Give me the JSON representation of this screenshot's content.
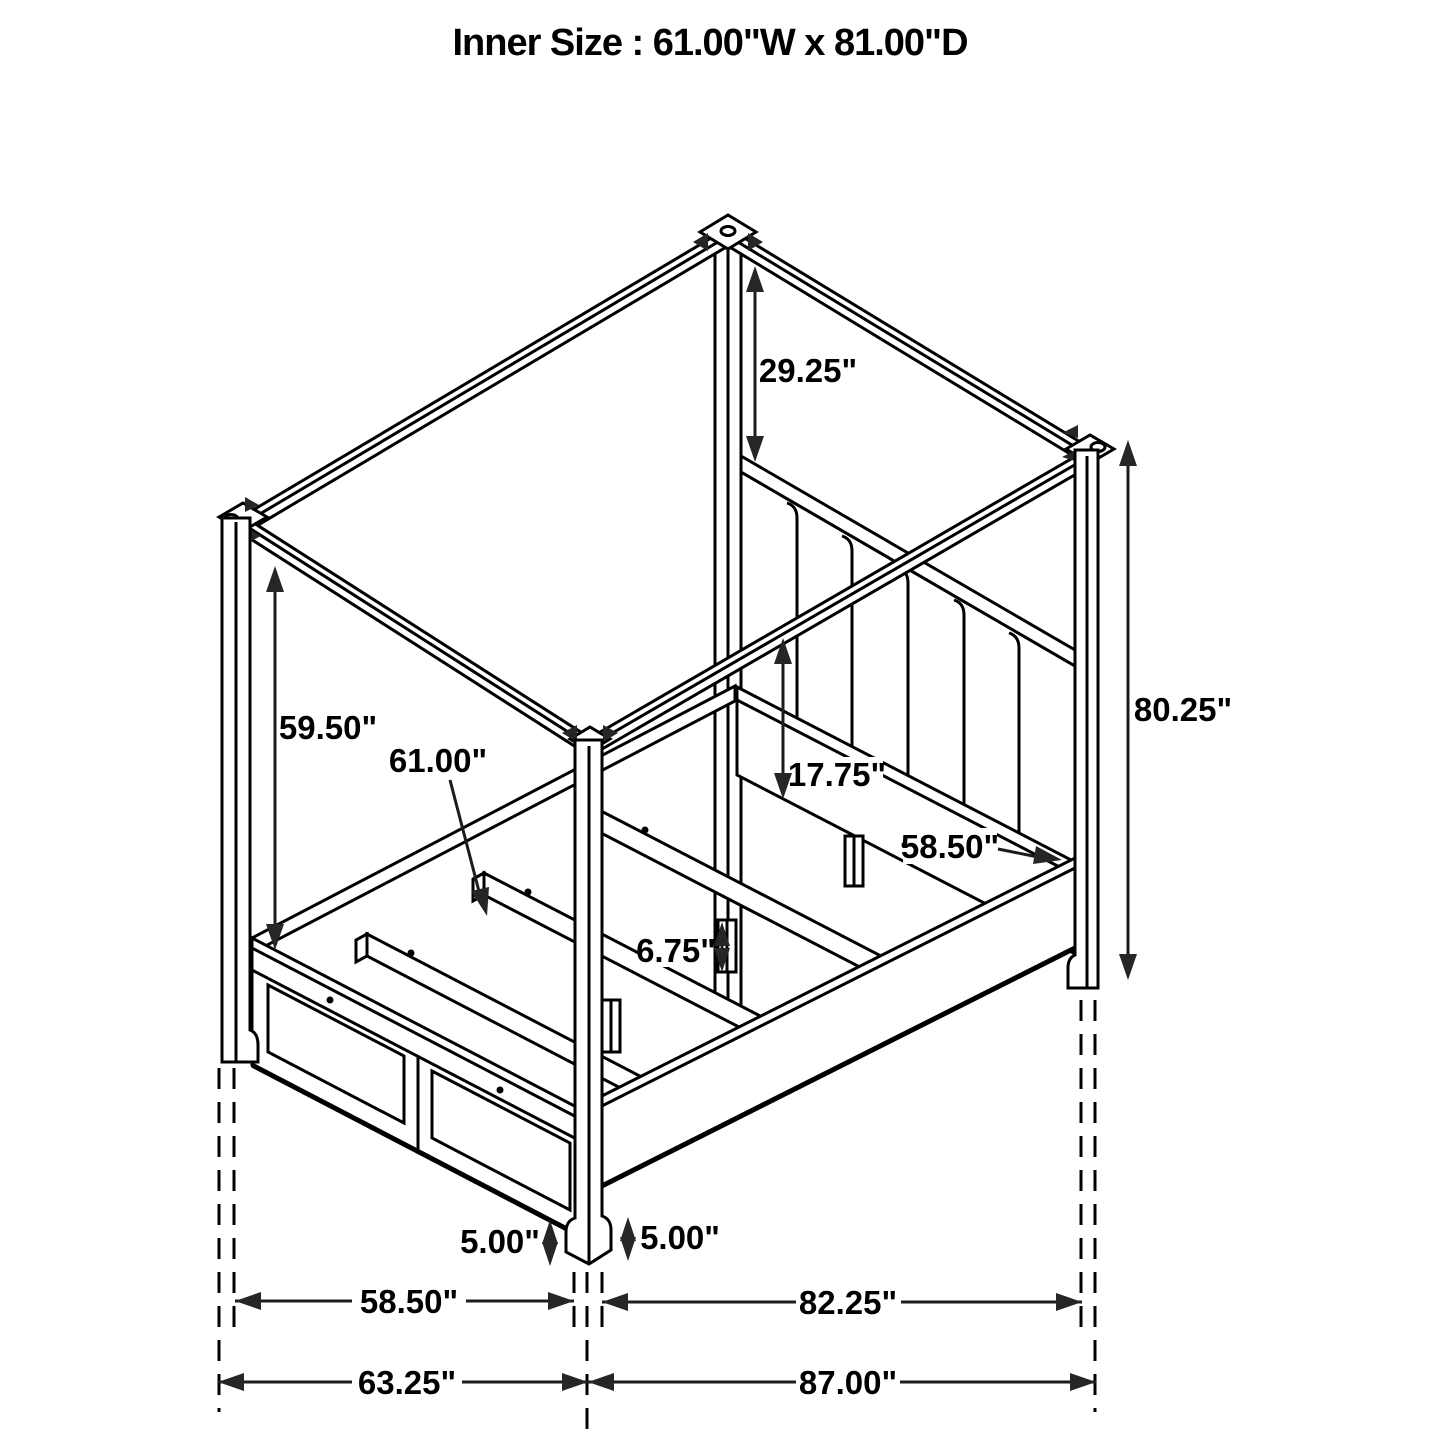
{
  "title": "Inner Size : 61.00\"W x 81.00\"D",
  "drawing": {
    "subject": "four-poster canopy storage bed dimension diagram",
    "units": "inches",
    "line_color": "#000000",
    "background_color": "#ffffff",
    "dims": {
      "d29_25": "29.25\"",
      "d80_25": "80.25\"",
      "d59_50": "59.50\"",
      "d61_00": "61.00\"",
      "d17_75": "17.75\"",
      "d58_50_side": "58.50\"",
      "d6_75": "6.75\"",
      "d5_00_left": "5.00\"",
      "d5_00_right": "5.00\"",
      "d58_50_bottom": "58.50\"",
      "d82_25": "82.25\"",
      "d63_25": "63.25\"",
      "d87_00": "87.00\""
    }
  }
}
